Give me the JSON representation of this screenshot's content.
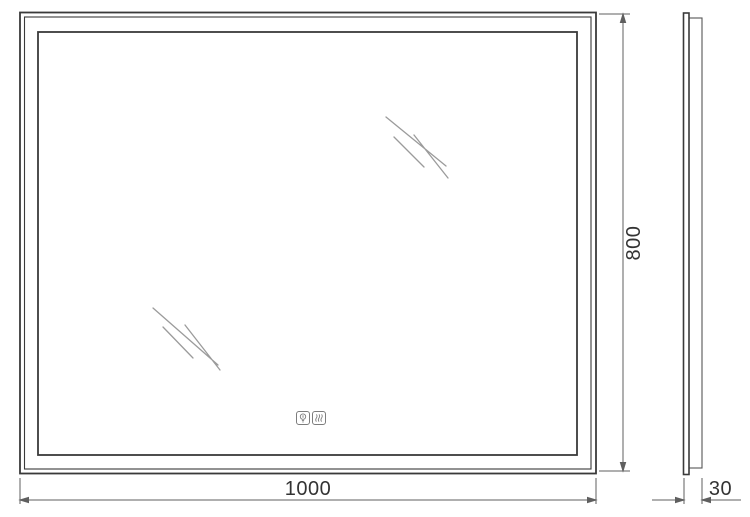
{
  "drawing": {
    "subject": "led-mirror-technical-drawing",
    "views": {
      "front": "front-view",
      "side": "side-profile-view"
    },
    "dimensions": {
      "width": {
        "label": "1000"
      },
      "height": {
        "label": "800"
      },
      "depth": {
        "label": "30"
      }
    },
    "icons": {
      "light": "light-bulb-icon",
      "antifog": "heat-waves-icon"
    },
    "colors": {
      "outline": "#3a3a3a",
      "inner_frame": "#3a3a3a",
      "dimension_lines": "#5f5f5f",
      "shine_marks": "#9b9b9b",
      "text": "#333333",
      "icon": "#7d7d7d",
      "background": "#ffffff"
    }
  }
}
